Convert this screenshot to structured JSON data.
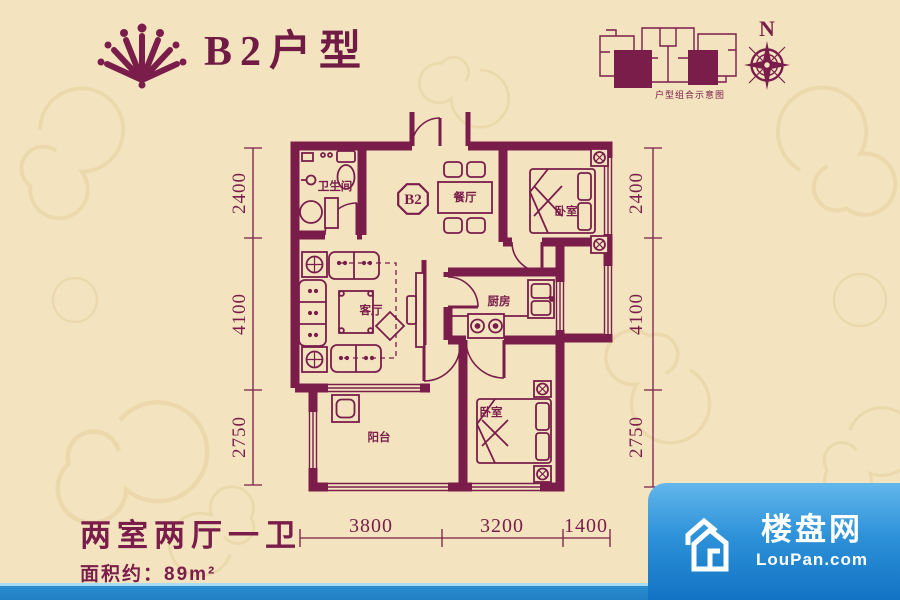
{
  "page": {
    "title": "B2户型",
    "compass_n": "N",
    "key_plan_caption": "户型组合示意图"
  },
  "floorplan": {
    "unit_badge": "B2",
    "rooms": {
      "bathroom": "卫生间",
      "dining": "餐厅",
      "bedroom_master": "卧室",
      "living": "客厅",
      "kitchen": "厨房",
      "balcony": "阳台",
      "bedroom_second": "卧室"
    },
    "dimensions": {
      "left": [
        "2400",
        "4100",
        "2750"
      ],
      "right": [
        "2400",
        "4100",
        "2750"
      ],
      "bottom": [
        "3800",
        "3200",
        "1400"
      ]
    }
  },
  "summary": {
    "layout_type": "两室两厅一卫",
    "area_text": "面积约：89m²"
  },
  "watermark": {
    "brand": "楼盘网",
    "domain": "LouPan.com"
  },
  "colors": {
    "background": "#f3e4bf",
    "wall": "#7a1d4b",
    "watermark_blue": "#1f86c9"
  }
}
